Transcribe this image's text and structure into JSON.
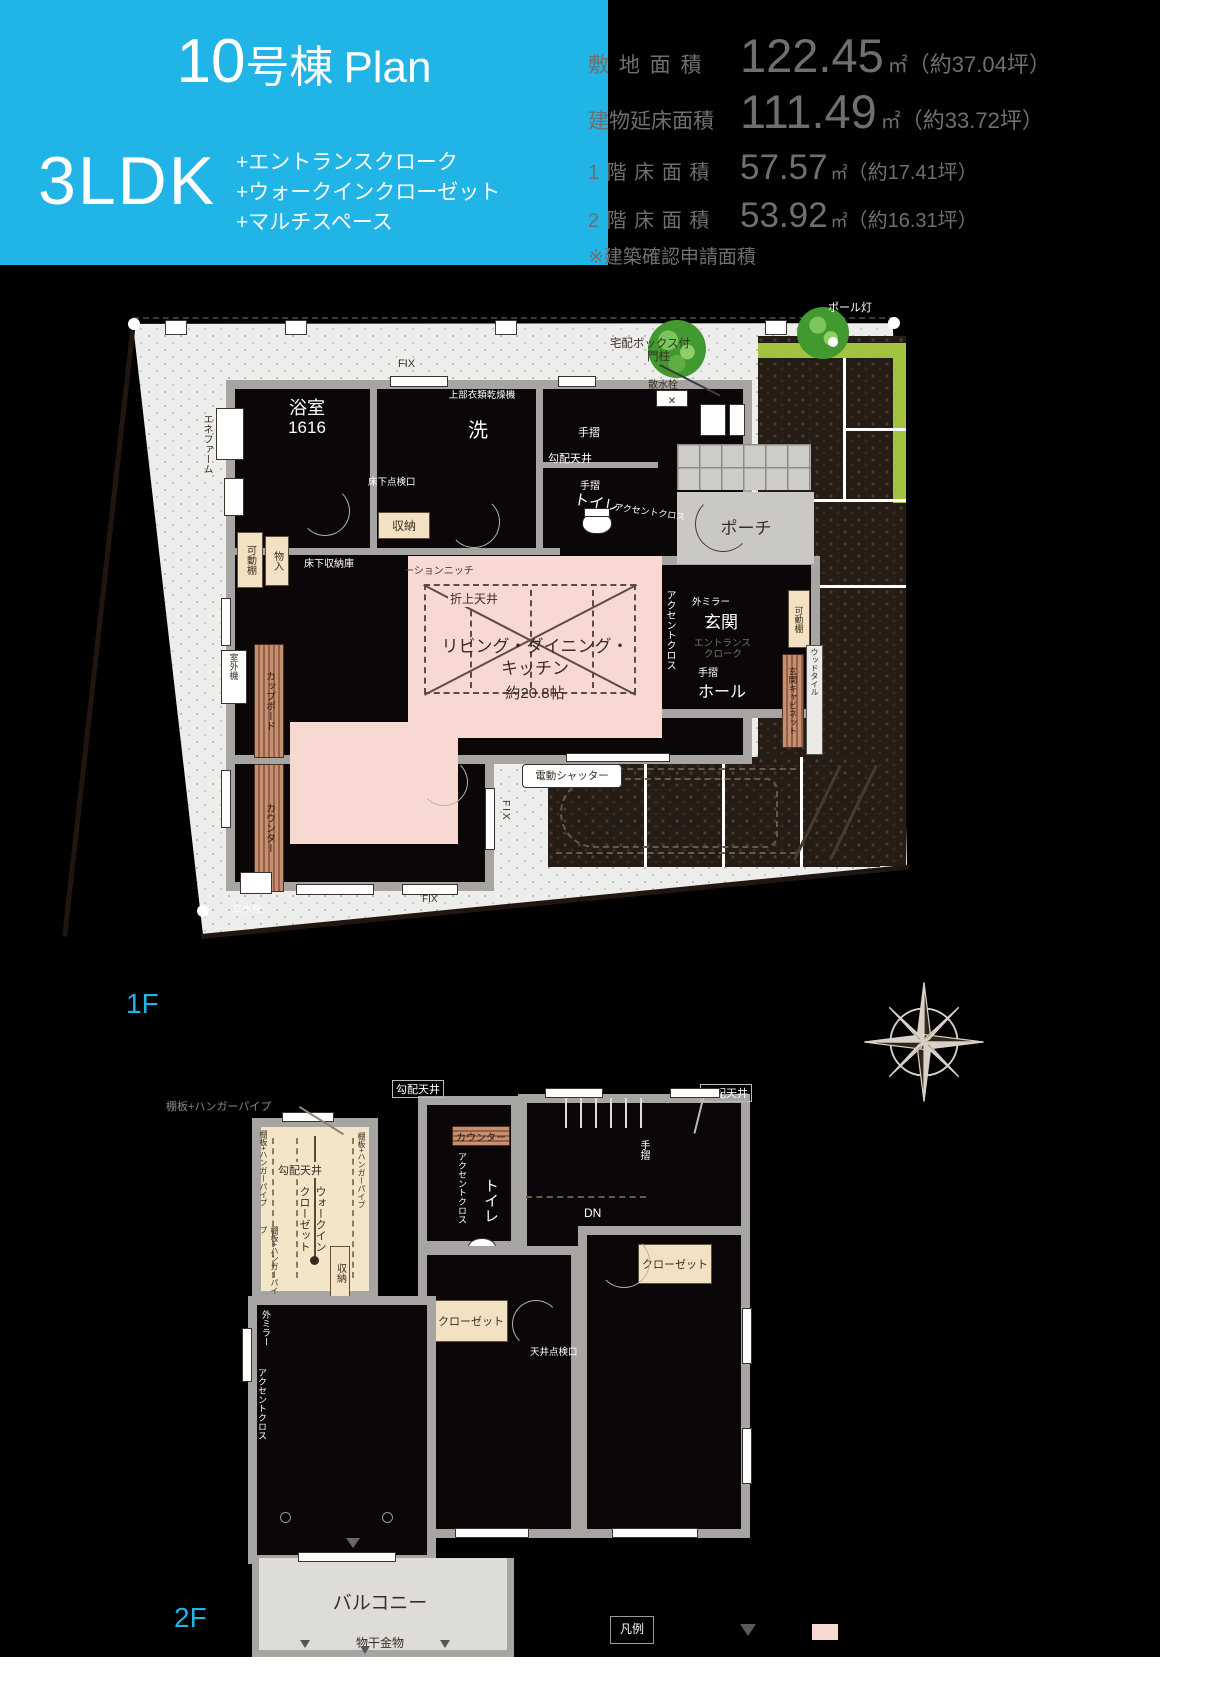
{
  "header": {
    "accent": "#21b4e6",
    "building_no": "10",
    "building_suffix": "号棟",
    "plan_word": "Plan",
    "layout_type": "3LDK",
    "features": [
      "+エントランスクローク",
      "+ウォークインクローゼット",
      "+マルチスペース"
    ]
  },
  "areas": {
    "rows": [
      {
        "label": "敷 地 面 積",
        "value": "122.45",
        "unit": "㎡",
        "tsubo": "（約37.04坪）"
      },
      {
        "label": "建物延床面積",
        "value": "111.49",
        "unit": "㎡",
        "tsubo": "（約33.72坪）"
      },
      {
        "label": "1 階 床 面 積",
        "value": "57.57",
        "unit": "㎡",
        "tsubo": "（約17.41坪）"
      },
      {
        "label": "2 階 床 面 積",
        "value": "53.92",
        "unit": "㎡",
        "tsubo": "（約16.31坪）"
      }
    ],
    "note": "※建築確認申請面積"
  },
  "floors": {
    "f1": "1F",
    "f2": "2F"
  },
  "legend": {
    "title": "凡例"
  },
  "terms": {
    "ene_farm": "エネファーム",
    "bath": "浴室",
    "bath_size": "1616",
    "upper_dryer": "上部衣類乾燥機",
    "wash": "洗",
    "fix": "FIX",
    "handrail": "手摺",
    "sloped_ceiling": "勾配天井",
    "toilet": "トイレ",
    "accent_cross": "アクセントクロス",
    "storage": "収納",
    "movable_shelf": "可動棚",
    "closet_in": "物入",
    "underfloor_access": "床下点検口",
    "underfloor_storage": "床下収納庫",
    "delivery_box_1": "宅配ボックス付",
    "delivery_box_2": "門柱",
    "sprinkler": "散水栓",
    "porch": "ポーチ",
    "pole_light": "ポール灯",
    "niche": "ーションニッチ",
    "coffered_ceiling": "折上天井",
    "ldk_1": "リビング・ダイニング・",
    "ldk_2": "キッチン",
    "ldk_size": "約20.8帖",
    "ext_mirror": "外ミラー",
    "entrance": "玄関",
    "entrance_cloak_1": "エントランス",
    "entrance_cloak_2": "クローク",
    "hall": "ホール",
    "entrance_cabinet": "玄関キャビネット",
    "wood_tile": "ウッドタイル",
    "cupboard": "カップボード",
    "counter": "カウンター",
    "outdoor_unit": "室外機",
    "electric_shutter": "電動シャッター",
    "water_tap": "立水栓",
    "shelf_pipe": "棚板+ハンガーパイプ",
    "wic_1": "ウォークイン",
    "wic_2": "クローゼット",
    "dn": "DN",
    "closet": "クローゼット",
    "ceiling_access": "天井点検口",
    "balcony": "バルコニー",
    "drying": "物干金物"
  }
}
